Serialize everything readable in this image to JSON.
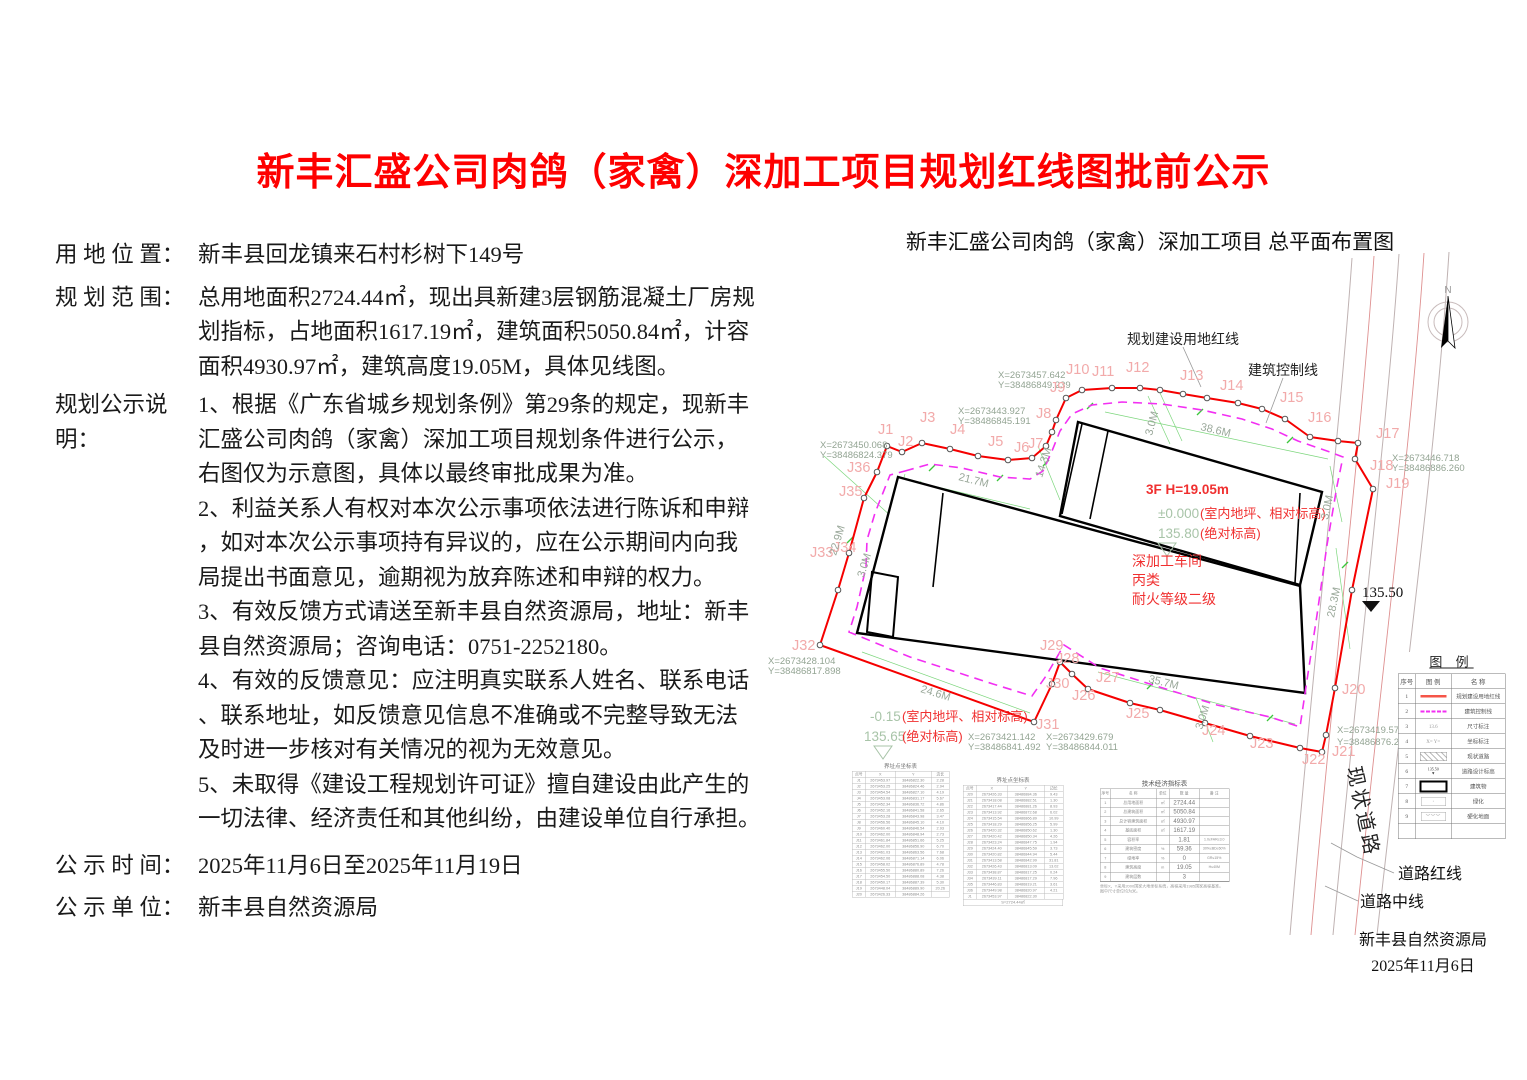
{
  "title": "新丰汇盛公司肉鸽（家禽）深加工项目规划红线图批前公示",
  "title_color": "#fe0000",
  "info": {
    "location_label": "用 地 位 置：",
    "location_value": "新丰县回龙镇来石村杉树下149号",
    "scope_label": "规 划 范 围：",
    "scope_lines": [
      "总用地面积2724.44㎡，现出具新建3层钢筋混凝土厂房规",
      "划指标，占地面积1617.19㎡，建筑面积5050.84㎡，计容",
      "面积4930.97㎡，建筑高度19.05M，具体见线图。"
    ],
    "notice_label": "规划公示说明：",
    "notice_lines": [
      "1、根据《广东省城乡规划条例》第29条的规定，现新丰",
      "汇盛公司肉鸽（家禽）深加工项目规划条件进行公示，",
      "右图仅为示意图，具体以最终审批成果为准。",
      "2、利益关系人有权对本次公示事项依法进行陈诉和申辩",
      "，如对本次公示事项持有异议的，应在公示期间内向我",
      "局提出书面意见，逾期视为放弃陈述和申辩的权力。",
      "3、有效反馈方式请送至新丰县自然资源局，地址：新丰",
      "县自然资源局；咨询电话：0751-2252180。",
      "4、有效的反馈意见：应注明真实联系人姓名、联系电话",
      "、联系地址，如反馈意见信息不准确或不完整导致无法",
      "及时进一步核对有关情况的视为无效意见。",
      "5、未取得《建设工程规划许可证》擅自建设由此产生的",
      "一切法律、经济责任和其他纠纷，由建设单位自行承担。"
    ],
    "time_label": "公 示 时 间：",
    "time_value": "2025年11月6日至2025年11月19日",
    "unit_label": "公 示 单 位：",
    "unit_value": "新丰县自然资源局"
  },
  "map": {
    "title": "新丰汇盛公司肉鸽（家禽）深加工项目 总平面布置图",
    "red_line_color": "#f50000",
    "control_line_color": "#f22ff2",
    "labels": [
      {
        "t": "规划建设用地红线",
        "x": 1183,
        "y": 344,
        "c": "blk",
        "a": "middle"
      },
      {
        "t": "建筑控制线",
        "x": 1283,
        "y": 375,
        "c": "blk",
        "a": "middle"
      },
      {
        "t": "135.50",
        "x": 1362,
        "y": 597,
        "c": "blk15"
      },
      {
        "t": "道路红线",
        "x": 1398,
        "y": 879,
        "c": "blk16"
      },
      {
        "t": "道路中线",
        "x": 1360,
        "y": 907,
        "c": "blk16"
      },
      {
        "t": "现状道路",
        "x": 1347,
        "y": 768,
        "c": "road",
        "r": 78
      },
      {
        "t": "N",
        "x": 1448,
        "y": 293,
        "c": "nlbl",
        "a": "middle"
      },
      {
        "t": "3F H=19.05m",
        "x": 1146,
        "y": 494,
        "c": "red13b"
      },
      {
        "t": "±0.000",
        "x": 1158,
        "y": 518,
        "c": "grn13"
      },
      {
        "t": "(室内地坪、相对标高)",
        "x": 1200,
        "y": 518,
        "c": "red13"
      },
      {
        "t": "135.80",
        "x": 1158,
        "y": 538,
        "c": "grn13"
      },
      {
        "t": "(绝对标高)",
        "x": 1200,
        "y": 538,
        "c": "red13"
      },
      {
        "t": "深加工车间",
        "x": 1132,
        "y": 566,
        "c": "red14"
      },
      {
        "t": "丙类",
        "x": 1132,
        "y": 585,
        "c": "red14"
      },
      {
        "t": "耐火等级二级",
        "x": 1132,
        "y": 604,
        "c": "red14"
      },
      {
        "t": "-0.15",
        "x": 870,
        "y": 721,
        "c": "grn13"
      },
      {
        "t": "(室内地坪、相对标高)",
        "x": 902,
        "y": 721,
        "c": "red13"
      },
      {
        "t": "135.65",
        "x": 864,
        "y": 741,
        "c": "grn13"
      },
      {
        "t": "(绝对标高)",
        "x": 902,
        "y": 741,
        "c": "red13"
      },
      {
        "t": "X=2673457.642",
        "x": 998,
        "y": 378,
        "c": "coord"
      },
      {
        "t": "Y=38486849.239",
        "x": 998,
        "y": 388,
        "c": "coord"
      },
      {
        "t": "X=2673443.927",
        "x": 958,
        "y": 414,
        "c": "coord"
      },
      {
        "t": "Y=38486845.191",
        "x": 958,
        "y": 424,
        "c": "coord"
      },
      {
        "t": "X=2673450.068",
        "x": 820,
        "y": 448,
        "c": "coord"
      },
      {
        "t": "Y=38486824.379",
        "x": 820,
        "y": 458,
        "c": "coord"
      },
      {
        "t": "X=2673446.718",
        "x": 1392,
        "y": 461,
        "c": "coord"
      },
      {
        "t": "Y=38486886.260",
        "x": 1392,
        "y": 471,
        "c": "coord"
      },
      {
        "t": "X=2673428.104",
        "x": 768,
        "y": 664,
        "c": "coord"
      },
      {
        "t": "Y=38486817.898",
        "x": 768,
        "y": 674,
        "c": "coord"
      },
      {
        "t": "X=2673421.142",
        "x": 968,
        "y": 740,
        "c": "coord"
      },
      {
        "t": "Y=38486841.492",
        "x": 968,
        "y": 750,
        "c": "coord"
      },
      {
        "t": "X=2673429.679",
        "x": 1046,
        "y": 740,
        "c": "coord"
      },
      {
        "t": "Y=38486844.011",
        "x": 1046,
        "y": 750,
        "c": "coord"
      },
      {
        "t": "X=2673419.575",
        "x": 1337,
        "y": 733,
        "c": "coord"
      },
      {
        "t": "Y=38486876.251",
        "x": 1337,
        "y": 745,
        "c": "coord"
      },
      {
        "t": "J1",
        "x": 878,
        "y": 434,
        "c": "pink"
      },
      {
        "t": "J2",
        "x": 898,
        "y": 446,
        "c": "pink"
      },
      {
        "t": "J3",
        "x": 920,
        "y": 422,
        "c": "pink"
      },
      {
        "t": "J4",
        "x": 950,
        "y": 434,
        "c": "pink"
      },
      {
        "t": "J5",
        "x": 988,
        "y": 446,
        "c": "pink"
      },
      {
        "t": "J6",
        "x": 1014,
        "y": 452,
        "c": "pink"
      },
      {
        "t": "J7",
        "x": 1028,
        "y": 448,
        "c": "pink"
      },
      {
        "t": "J8",
        "x": 1036,
        "y": 418,
        "c": "pink"
      },
      {
        "t": "J9",
        "x": 1050,
        "y": 392,
        "c": "pink"
      },
      {
        "t": "J10",
        "x": 1066,
        "y": 374,
        "c": "pink"
      },
      {
        "t": "J11",
        "x": 1092,
        "y": 376,
        "c": "pink"
      },
      {
        "t": "J12",
        "x": 1126,
        "y": 372,
        "c": "pink"
      },
      {
        "t": "J13",
        "x": 1180,
        "y": 380,
        "c": "pink"
      },
      {
        "t": "J14",
        "x": 1220,
        "y": 390,
        "c": "pink"
      },
      {
        "t": "J15",
        "x": 1280,
        "y": 402,
        "c": "pink"
      },
      {
        "t": "J16",
        "x": 1308,
        "y": 422,
        "c": "pink"
      },
      {
        "t": "J17",
        "x": 1376,
        "y": 438,
        "c": "pink"
      },
      {
        "t": "J18",
        "x": 1370,
        "y": 470,
        "c": "pink"
      },
      {
        "t": "J19",
        "x": 1386,
        "y": 488,
        "c": "pink"
      },
      {
        "t": "J20",
        "x": 1342,
        "y": 694,
        "c": "pink"
      },
      {
        "t": "J21",
        "x": 1332,
        "y": 756,
        "c": "pink"
      },
      {
        "t": "J22",
        "x": 1302,
        "y": 764,
        "c": "pink"
      },
      {
        "t": "J23",
        "x": 1250,
        "y": 748,
        "c": "pink"
      },
      {
        "t": "J24",
        "x": 1202,
        "y": 735,
        "c": "pink"
      },
      {
        "t": "J25",
        "x": 1126,
        "y": 718,
        "c": "pink"
      },
      {
        "t": "J26",
        "x": 1072,
        "y": 700,
        "c": "pink"
      },
      {
        "t": "J27",
        "x": 1096,
        "y": 682,
        "c": "pink"
      },
      {
        "t": "J28",
        "x": 1056,
        "y": 663,
        "c": "pink"
      },
      {
        "t": "J29",
        "x": 1040,
        "y": 650,
        "c": "pink"
      },
      {
        "t": "J30",
        "x": 1046,
        "y": 688,
        "c": "pink"
      },
      {
        "t": "J31",
        "x": 1036,
        "y": 729,
        "c": "pink"
      },
      {
        "t": "J32",
        "x": 792,
        "y": 650,
        "c": "pink"
      },
      {
        "t": "J33",
        "x": 810,
        "y": 557,
        "c": "pink"
      },
      {
        "t": "J34",
        "x": 833,
        "y": 552,
        "c": "pink"
      },
      {
        "t": "J35",
        "x": 839,
        "y": 496,
        "c": "pink"
      },
      {
        "t": "J36",
        "x": 847,
        "y": 472,
        "c": "pink"
      },
      {
        "t": "21.7M",
        "x": 958,
        "y": 480,
        "c": "dim",
        "r": 14
      },
      {
        "t": "14.3M",
        "x": 1042,
        "y": 478,
        "c": "dim",
        "r": -72
      },
      {
        "t": "38.6M",
        "x": 1200,
        "y": 430,
        "c": "dim",
        "r": 13
      },
      {
        "t": "3.0M",
        "x": 1152,
        "y": 436,
        "c": "dim",
        "r": -75
      },
      {
        "t": "22.9M",
        "x": 836,
        "y": 556,
        "c": "dim",
        "r": -73
      },
      {
        "t": "3.0M",
        "x": 864,
        "y": 578,
        "c": "dim",
        "r": -73
      },
      {
        "t": "24.6M",
        "x": 920,
        "y": 692,
        "c": "dim",
        "r": 17
      },
      {
        "t": "35.7M",
        "x": 1148,
        "y": 682,
        "c": "dim",
        "r": 14
      },
      {
        "t": "3.0M",
        "x": 1202,
        "y": 730,
        "c": "dim",
        "r": -72
      },
      {
        "t": "28.3M",
        "x": 1334,
        "y": 618,
        "c": "dim",
        "r": -78
      },
      {
        "t": "3.0M",
        "x": 1328,
        "y": 520,
        "c": "dim",
        "r": -78
      }
    ]
  },
  "boundary_table1": {
    "title": "界址点坐标表",
    "header": [
      "点号",
      "X",
      "Y",
      "边长"
    ],
    "rows": [
      [
        "J1",
        "2673453.97",
        "38486822.30",
        "2.28"
      ],
      [
        "J2",
        "2673453.25",
        "38486824.46",
        "2.94"
      ],
      [
        "J3",
        "2673454.54",
        "38486827.10",
        "4.19"
      ],
      [
        "J4",
        "2673453.08",
        "38486831.17",
        "5.67"
      ],
      [
        "J5",
        "2673452.34",
        "38486836.72",
        "4.86"
      ],
      [
        "J6",
        "2673452.16",
        "38486841.58",
        "2.65"
      ],
      [
        "J7",
        "2673453.28",
        "38486843.98",
        "3.47"
      ],
      [
        "J8",
        "2673456.56",
        "38486845.10",
        "4.10"
      ],
      [
        "J9",
        "2673460.40",
        "38486846.54",
        "2.93"
      ],
      [
        "J10",
        "2673462.00",
        "38486848.94",
        "2.73"
      ],
      [
        "J11",
        "2673461.84",
        "38486851.66",
        "5.25"
      ],
      [
        "J12",
        "2673462.00",
        "38486856.90",
        "6.70"
      ],
      [
        "J13",
        "2673461.03",
        "38486863.56",
        "7.68"
      ],
      [
        "J14",
        "2673462.06",
        "38486871.14",
        "6.06"
      ],
      [
        "J15",
        "2673458.02",
        "38486876.89",
        "4.78"
      ],
      [
        "J16",
        "2673455.50",
        "38486880.89",
        "7.26"
      ],
      [
        "J17",
        "2673454.50",
        "38486888.08",
        "4.38"
      ],
      [
        "J18",
        "2673450.17",
        "38486887.39",
        "5.30"
      ],
      [
        "J19",
        "2673448.04",
        "38486889.90",
        "20.26"
      ],
      [
        "J20",
        "2673426.33",
        "38486884.26",
        ""
      ]
    ]
  },
  "boundary_table2": {
    "title": "界址点坐标表",
    "header": [
      "点号",
      "X",
      "Y",
      "边长"
    ],
    "rows": [
      [
        "J20",
        "2673426.33",
        "38486884.36",
        "9.43"
      ],
      [
        "J21",
        "2673418.08",
        "38486882.51",
        "1.30"
      ],
      [
        "J22",
        "2673417.44",
        "38486881.26",
        "8.93"
      ],
      [
        "J23",
        "2673413.92",
        "38486872.68",
        "6.02"
      ],
      [
        "J24",
        "2673415.54",
        "38486866.89",
        "10.99"
      ],
      [
        "J25",
        "2673418.29",
        "38486856.25",
        "5.99"
      ],
      [
        "J26",
        "2673420.32",
        "38486850.62",
        "1.30"
      ],
      [
        "J27",
        "2673420.42",
        "38486850.34",
        "4.26"
      ],
      [
        "J28",
        "2673423.24",
        "38486847.75",
        "1.94"
      ],
      [
        "J29",
        "2673424.40",
        "38486845.59",
        "3.73"
      ],
      [
        "J30",
        "2673420.82",
        "38486844.94",
        "5.44"
      ],
      [
        "J31",
        "2673413.58",
        "38486842.99",
        "31.81"
      ],
      [
        "J32",
        "2673426.43",
        "38486813.09",
        "13.02"
      ],
      [
        "J33",
        "2673438.87",
        "38486817.25",
        "0.24"
      ],
      [
        "J34",
        "2673439.11",
        "38486817.29",
        "7.96"
      ],
      [
        "J35",
        "2673446.83",
        "38486819.21",
        "3.61"
      ],
      [
        "J36",
        "2673449.98",
        "38486820.97",
        "4.21"
      ],
      [
        "J1",
        "2673453.97",
        "38486822.30",
        ""
      ]
    ],
    "footer": "S=2724.44㎡"
  },
  "tech_table": {
    "title": "技术经济指标表",
    "header": [
      "序号",
      "名  称",
      "单位",
      "数  量",
      "备  注"
    ],
    "rows": [
      [
        "1",
        "总用地面积",
        "㎡",
        "2724.44",
        ""
      ],
      [
        "2",
        "总建筑面积",
        "㎡",
        "5050.84",
        ""
      ],
      [
        "3",
        "总计容建筑面积",
        "㎡",
        "4930.97",
        ""
      ],
      [
        "4",
        "基底面积",
        "㎡",
        "1617.19",
        ""
      ],
      [
        "5",
        "容积率",
        "",
        "1.81",
        "1.0≤FAR≤3.0"
      ],
      [
        "6",
        "建筑密度",
        "%",
        "59.36",
        "30%≤BD≤60%"
      ],
      [
        "7",
        "绿地率",
        "%",
        "0",
        "GR≤15%"
      ],
      [
        "8",
        "建筑高度",
        "m",
        "19.05",
        "H≤40M"
      ],
      [
        "9",
        "建筑层数",
        "",
        "3",
        ""
      ],
      [
        "",
        "",
        "",
        "",
        ""
      ]
    ],
    "notes": [
      "坐标X、Y采用2000国家大地坐标系统，高程采用1985国家高程基准。",
      "图中尺寸单位均为米。"
    ]
  },
  "legend": {
    "title": "图 例",
    "header": [
      "序号",
      "图 例",
      "名 称"
    ],
    "rows": [
      {
        "num": "1",
        "name": "规划建设用地红线"
      },
      {
        "num": "2",
        "name": "建筑控制线"
      },
      {
        "num": "3",
        "name": "尺寸标注"
      },
      {
        "num": "4",
        "name": "坐标标注"
      },
      {
        "num": "5",
        "name": "现状道路"
      },
      {
        "num": "6",
        "name": "道路设计标高"
      },
      {
        "num": "7",
        "name": "建筑物"
      },
      {
        "num": "8",
        "name": "绿化"
      },
      {
        "num": "9",
        "name": "硬化地面"
      }
    ],
    "glyph3": "13.6",
    "glyph4": "X= Y=",
    "glyph6": "135.50",
    "glyph8": "·",
    "glyph9": "︶︶︶"
  },
  "sign": {
    "org": "新丰县自然资源局",
    "date": "2025年11月6日"
  }
}
